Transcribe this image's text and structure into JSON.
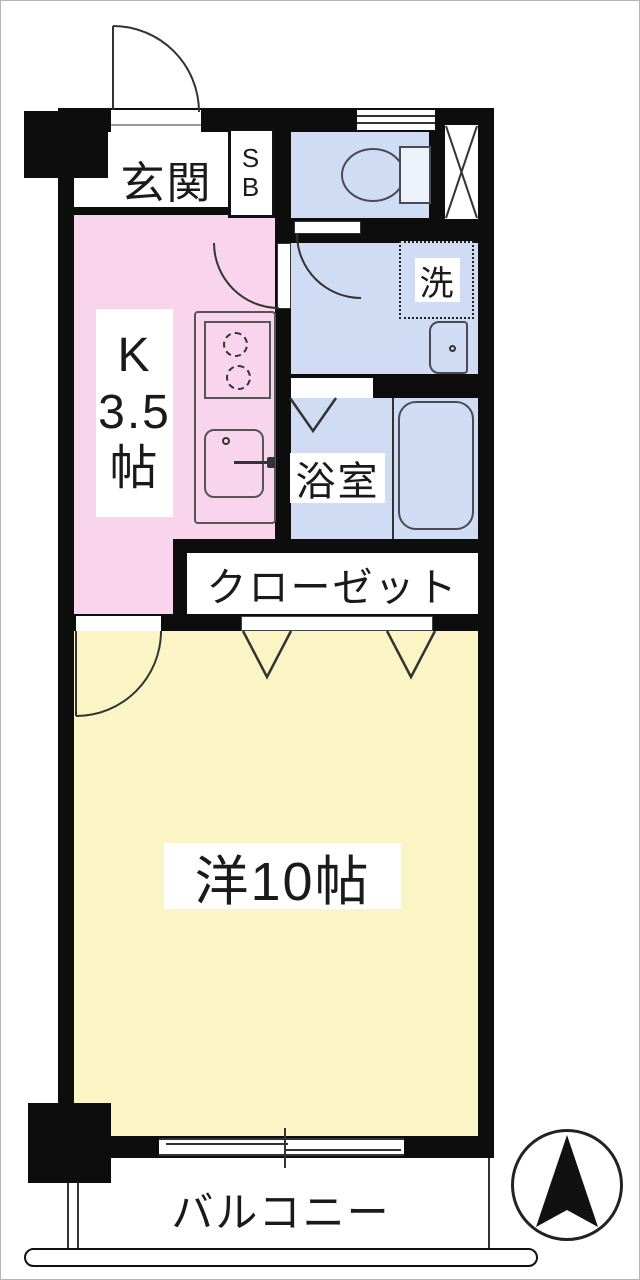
{
  "plan": {
    "type": "apartment-floor-plan",
    "rooms": {
      "genkan": {
        "label": "玄関"
      },
      "shoe_box": {
        "label_lines": [
          "S",
          "B"
        ]
      },
      "toilet": {
        "fixture": "toilet"
      },
      "pipe_space": {
        "symbol": "x-cross"
      },
      "kitchen": {
        "label_lines": [
          "K",
          "3.5",
          "帖"
        ],
        "fixtures": [
          "two-burner-stove",
          "sink"
        ]
      },
      "washroom": {
        "washer_label": "洗",
        "fixtures": [
          "washing-machine-space",
          "washbasin"
        ]
      },
      "bathroom": {
        "label": "浴室",
        "fixtures": [
          "bathtub",
          "folding-door"
        ]
      },
      "closet": {
        "label": "クローゼット",
        "doors": "two-folding-panels"
      },
      "western_room": {
        "label": "洋10帖",
        "door": "hinged",
        "window": "sliding"
      },
      "balcony": {
        "label": "バルコニー"
      }
    },
    "compass": {
      "points": "north"
    },
    "colors": {
      "wall": "#0d0d0d",
      "kitchen_pink": "#f8d5ec",
      "wet_area_blue": "#cfdcf4",
      "room_yellow": "#fbf5c6",
      "outline_gray": "#4a4a55"
    }
  }
}
